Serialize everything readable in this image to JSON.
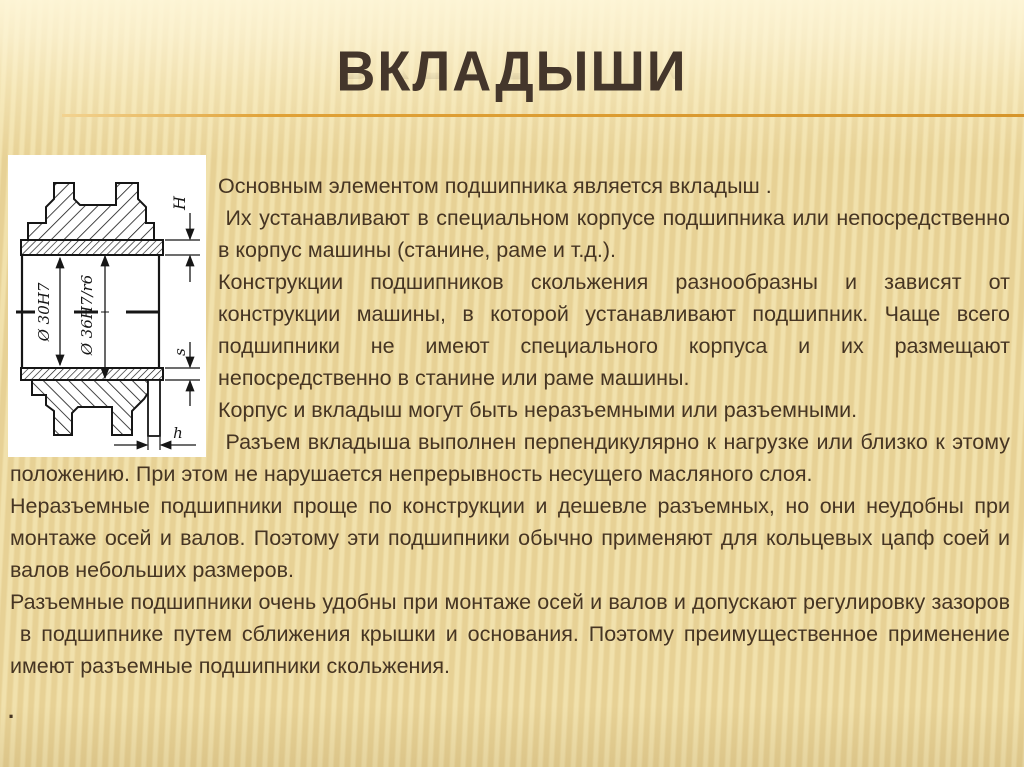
{
  "header": {
    "title": "ВКЛАДЫШИ"
  },
  "figure": {
    "description": "bearing-shell-cross-section-drawing",
    "labels": {
      "bore_diameter": "Ø 30H7",
      "outer_fit": "Ø 36H7/r6",
      "flange_height": "H",
      "wall_thickness": "s",
      "flange_width": "h"
    }
  },
  "content": {
    "paragraphs": [
      "Основным элементом подшипника является вкладыш .",
      " Их устанавливают в специальном корпусе подшипника или непосредственно в корпус машины (станине, раме и т.д.).",
      "Конструкции подшипников скольжения разнообразны и зависят от конструкции машины, в которой устанавливают подшипник. Чаще всего подшипники не имеют специального корпуса и их размещают непосредственно в станине или раме машины.",
      "Корпус и вкладыш могут быть неразъемными или разъемными.",
      " Разъем вкладыша выполнен перпендикулярно к нагрузке или близко к этому положению. При этом не нарушается непрерывность несущего масляного слоя.",
      "Неразъемные подшипники проще по конструкции и дешевле разъемных, но они неудобны при монтаже осей и валов. Поэтому эти подшипники обычно применяют для кольцевых цапф соей и валов небольших размеров.",
      "Разъемные подшипники очень удобны при монтаже осей и валов и допускают регулировку зазоров  в подшипнике путем сближения крышки и основания. Поэтому преимущественное применение имеют разъемные подшипники скольжения."
    ],
    "trailing_mark": "."
  },
  "colors": {
    "background": "#ecd99f",
    "top_band": "#fdf4d2",
    "accent_line": "#dd9a2e",
    "title_text": "#44362b",
    "body_text": "#463523",
    "drawing_ink": "#161616",
    "drawing_paper": "#ffffff"
  }
}
